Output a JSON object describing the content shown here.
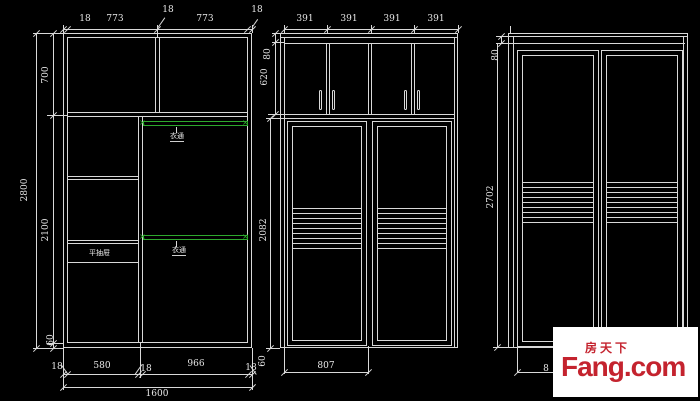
{
  "colors": {
    "background": "#000000",
    "line": "#d9d9d9",
    "rail_green": "#2da82d",
    "logo_red": "#c4232e",
    "logo_bg": "#ffffff"
  },
  "view1": {
    "top_dims": [
      "18",
      "773",
      "18",
      "773",
      "18"
    ],
    "side_dims": {
      "h700": "700",
      "h2800": "2800",
      "h2100": "2100",
      "kick": "60"
    },
    "bottom_dims": {
      "wall_left": "18",
      "w580": "580",
      "wall_mid": "18",
      "w966": "966",
      "wall_right": "18",
      "total": "1600"
    },
    "labels": {
      "rail_top": "衣通",
      "rail_bottom": "衣通",
      "drawer": "平抽屉"
    }
  },
  "view2": {
    "top_dims": [
      "391",
      "391",
      "391",
      "391"
    ],
    "side_dims": {
      "h80": "80",
      "h620": "620",
      "h2082": "2082",
      "kick": "60"
    },
    "bottom_dims": {
      "door_width": "807"
    }
  },
  "view3": {
    "side_dims": {
      "h80": "80",
      "h2702": "2702"
    },
    "bottom_dims": {
      "partial": "8"
    }
  },
  "watermark": {
    "brand_cn": "房天下",
    "brand_en": "Fang.com"
  }
}
